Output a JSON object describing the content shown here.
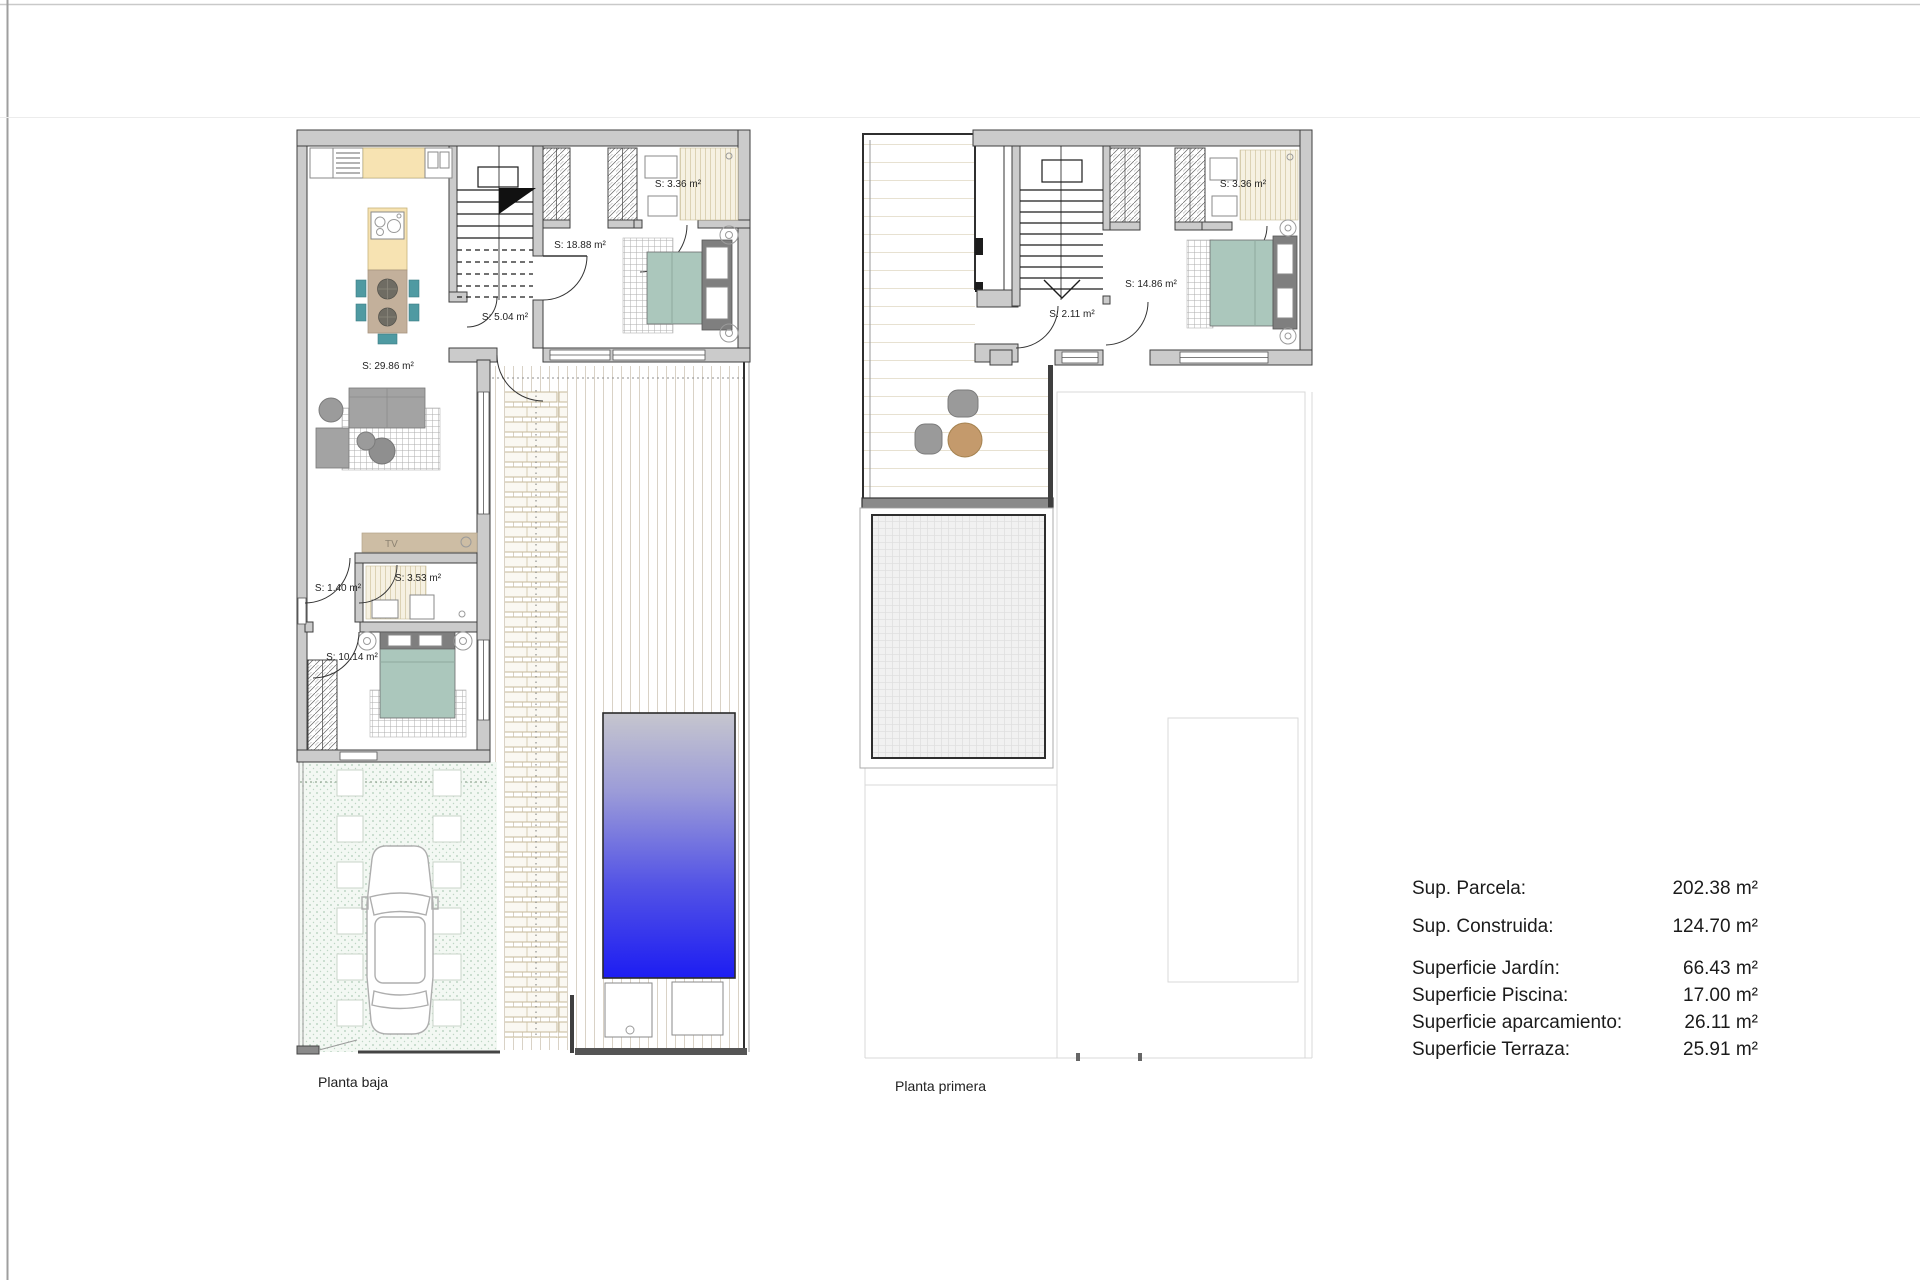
{
  "page": {
    "bg": "#ffffff"
  },
  "colors": {
    "wall": "#cbcbcb",
    "wall_edge": "#3f3f3f",
    "counter": "#f7e3b2",
    "table_wood": "#c3b09b",
    "chair_teal": "#4f9aa2",
    "stool": "#6f6c63",
    "bed": "#abc7bc",
    "headboard": "#7f7f7f",
    "sofa": "#a3a3a3",
    "tv_unit": "#cdbda4",
    "terrace_table": "#c49a6c",
    "terrace_chair": "#9a9a9a",
    "pool_top": "#c6c6ce",
    "pool_mid": "#9b9bd8",
    "pool_deep": "#5353e6",
    "pool_bottom": "#1d1df2",
    "garden_dot": "#9dbfa6",
    "plank": "#d9d2c6"
  },
  "plans": {
    "baja": {
      "title": "Planta baja",
      "tv": "TV",
      "rooms": {
        "living_kitchen": "S: 29.86 m²",
        "bedroom_main": "S: 18.88 m²",
        "hall": "S: 5.04 m²",
        "bathroom_top": "S: 3.36 m²",
        "storage": "S: 1.40 m²",
        "bathroom": "S: 3.53 m²",
        "bedroom_second": "S: 10.14 m²"
      }
    },
    "primera": {
      "title": "Planta primera",
      "rooms": {
        "landing": "S: 2.11 m²",
        "bedroom": "S: 14.86 m²",
        "bathroom": "S: 3.36 m²"
      }
    }
  },
  "summary": {
    "rows": [
      {
        "label": "Sup. Parcela:",
        "value": "202.38 m²"
      },
      {
        "label": "Sup. Construida:",
        "value": "124.70 m²"
      },
      {
        "label": "Superficie Jardín:",
        "value": "66.43 m²"
      },
      {
        "label": "Superficie Piscina:",
        "value": "17.00 m²"
      },
      {
        "label": "Superficie aparcamiento:",
        "value": "26.11 m²"
      },
      {
        "label": "Superficie Terraza:",
        "value": "25.91 m²"
      }
    ]
  }
}
